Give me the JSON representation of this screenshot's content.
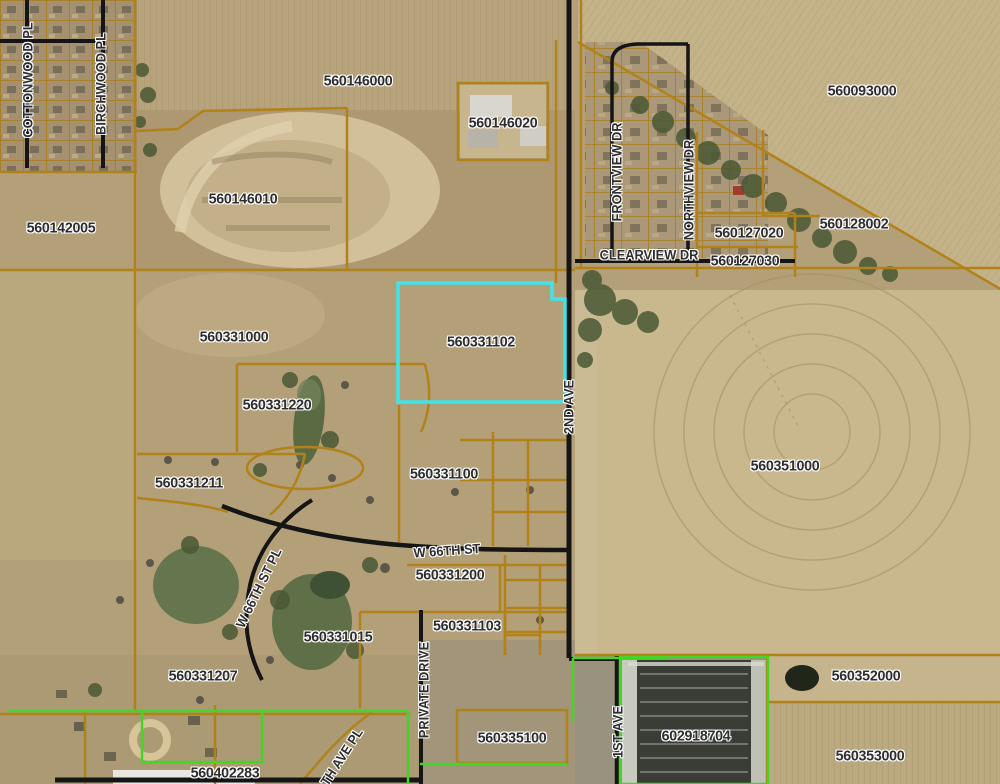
{
  "map": {
    "title": "County GIS aerial parcel map",
    "selected_parcel_id": "560331102",
    "colors": {
      "selected_parcel_outline": "#3fe4e8",
      "parcel_line": "#b2821a",
      "subdivision_boundary_green": "#46d42a",
      "road": "#151515",
      "label_text": "#2e2e31",
      "label_halo": "#ffffff"
    },
    "parcel_labels": [
      {
        "text": "560146000"
      },
      {
        "text": "560146020"
      },
      {
        "text": "560146010"
      },
      {
        "text": "560142005"
      },
      {
        "text": "560093000"
      },
      {
        "text": "560127020"
      },
      {
        "text": "560127030"
      },
      {
        "text": "560128002"
      },
      {
        "text": "560331000"
      },
      {
        "text": "560331102"
      },
      {
        "text": "560331220"
      },
      {
        "text": "560331211"
      },
      {
        "text": "560331100"
      },
      {
        "text": "560351000"
      },
      {
        "text": "560331200"
      },
      {
        "text": "560331103"
      },
      {
        "text": "560331015"
      },
      {
        "text": "560331207"
      },
      {
        "text": "560335100"
      },
      {
        "text": "602918704"
      },
      {
        "text": "560352000"
      },
      {
        "text": "560353000"
      },
      {
        "text": "560402283"
      }
    ],
    "street_labels": [
      {
        "text": "COTTONWOOD PL"
      },
      {
        "text": "BIRCHWOOD PL"
      },
      {
        "text": "FRONTVIEW DR"
      },
      {
        "text": "NORTHVIEW DR"
      },
      {
        "text": "CLEARVIEW DR"
      },
      {
        "text": "2ND AVE"
      },
      {
        "text": "W 66TH ST"
      },
      {
        "text": "W 66TH ST PL"
      },
      {
        "text": "PRIVATE DRIVE"
      },
      {
        "text": "1ST AVE"
      },
      {
        "text": "TH AVE PL"
      }
    ]
  }
}
